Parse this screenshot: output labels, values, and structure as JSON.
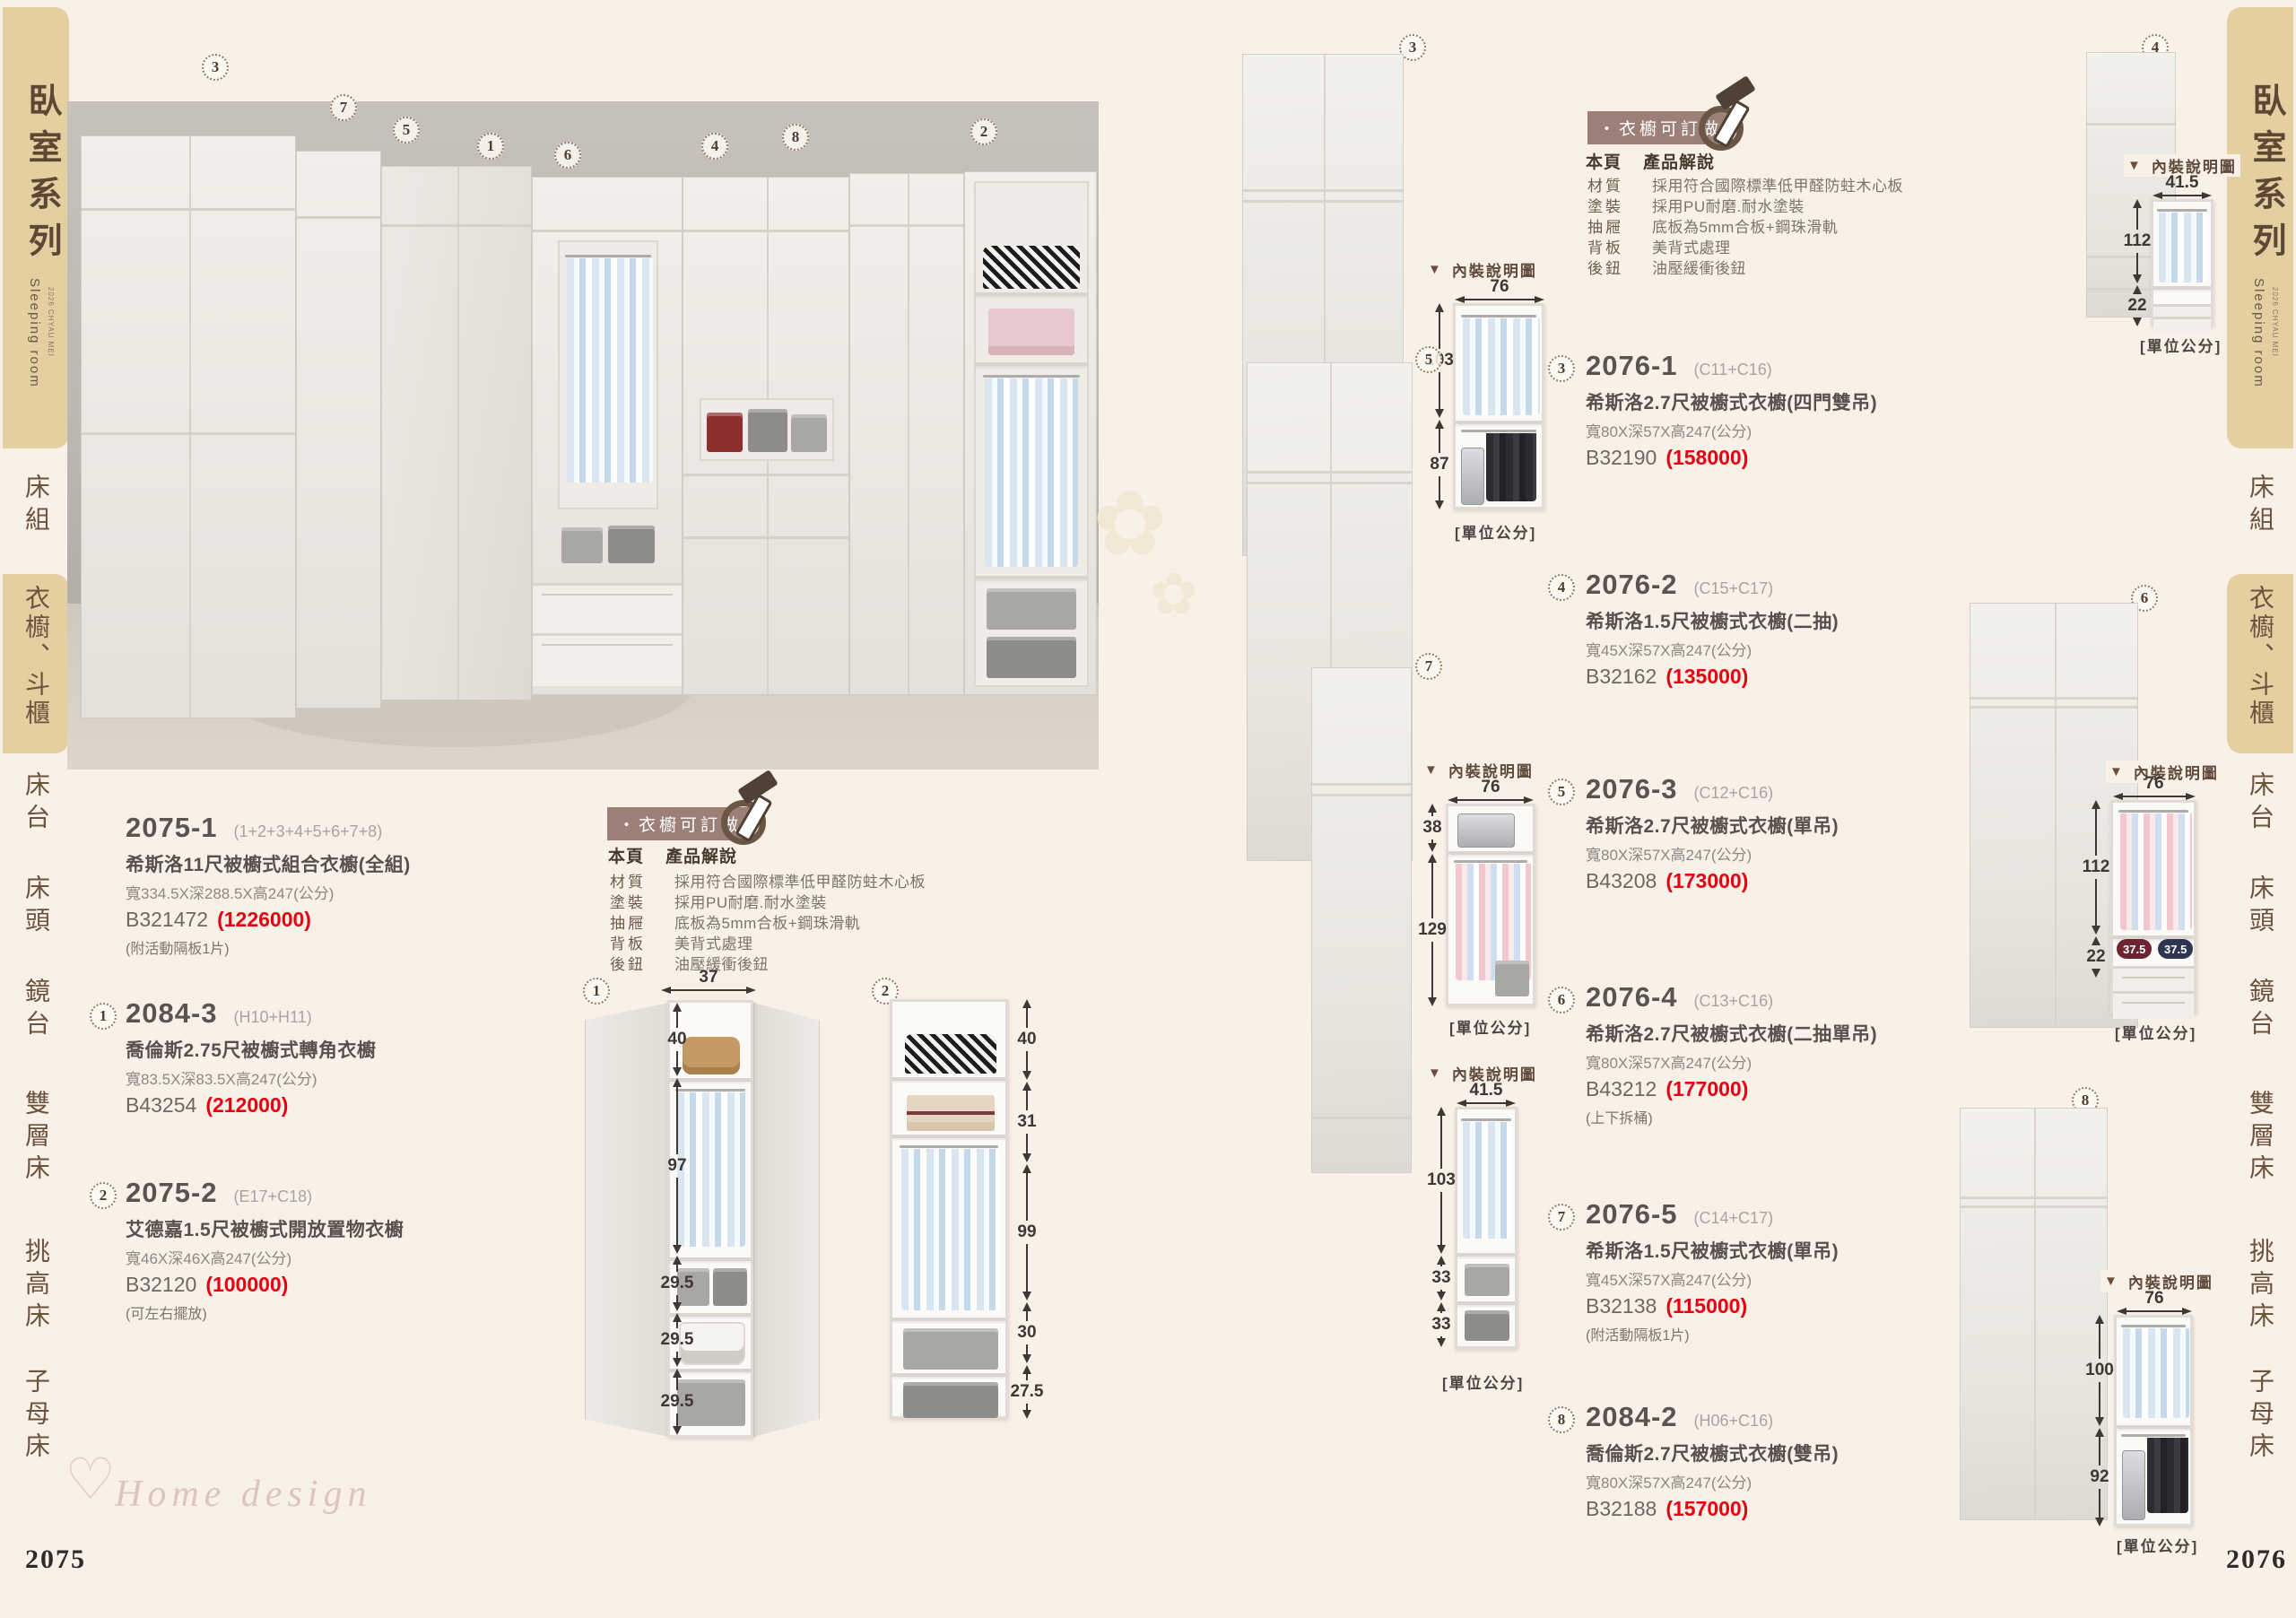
{
  "labels": {
    "diagram_caption": "內裝說明圖",
    "caption_arrow": "▼",
    "unit": "[單位公分]"
  },
  "sidebar": {
    "title": "臥室系列",
    "subtitle": "Sleeping room",
    "note": "2026 CHYAU MEI",
    "items": [
      "床組",
      "衣櫥、斗櫃",
      "床台",
      "床頭",
      "鏡台",
      "雙層床",
      "挑高床",
      "子母床"
    ]
  },
  "spec": {
    "badge": "・衣櫥可訂做",
    "header_page": "本頁",
    "header_title": "產品解說",
    "rows": [
      {
        "k": "材質",
        "v": "採用符合國際標準低甲醛防蛀木心板"
      },
      {
        "k": "塗裝",
        "v": "採用PU耐磨.耐水塗裝"
      },
      {
        "k": "抽屜",
        "v": "底板為5mm合板+鋼珠滑軌"
      },
      {
        "k": "背板",
        "v": "美背式處理"
      },
      {
        "k": "後鈕",
        "v": "油壓緩衝後鈕"
      }
    ]
  },
  "left_page": {
    "page_number": "2075",
    "watermark_heart": "♡",
    "watermark": "Home design",
    "flower": "✿",
    "photo_markers": [
      "3",
      "7",
      "5",
      "1",
      "6",
      "4",
      "8",
      "2"
    ],
    "products": [
      {
        "code": "2075-1",
        "combo": "(1+2+3+4+5+6+7+8)",
        "name": "希斯洛11尺被櫥式組合衣櫥(全組)",
        "size": "寬334.5X深288.5X高247(公分)",
        "sku": "B321472",
        "price": "(1226000)",
        "note": "(附活動隔板1片)"
      },
      {
        "marker": "1",
        "code": "2084-3",
        "combo": "(H10+H11)",
        "name": "喬倫斯2.75尺被櫥式轉角衣櫥",
        "size": "寬83.5X深83.5X高247(公分)",
        "sku": "B43254",
        "price": "(212000)"
      },
      {
        "marker": "2",
        "code": "2075-2",
        "combo": "(E17+C18)",
        "name": "艾德嘉1.5尺被櫥式開放置物衣櫥",
        "size": "寬46X深46X高247(公分)",
        "sku": "B32120",
        "price": "(100000)",
        "note": "(可左右擺放)"
      }
    ],
    "diagram1": {
      "marker": "1",
      "width": "37",
      "s0": "40",
      "s1": "97",
      "s2": "29.5",
      "s3": "29.5",
      "s4": "29.5"
    },
    "diagram2": {
      "marker": "2",
      "s0": "40",
      "s1": "31",
      "s2": "99",
      "s3": "30",
      "s4": "27.5"
    }
  },
  "right_page": {
    "page_number": "2076",
    "photo_markers": [
      "3",
      "4",
      "5",
      "6",
      "7",
      "8"
    ],
    "products": [
      {
        "marker": "3",
        "code": "2076-1",
        "combo": "(C11+C16)",
        "name": "希斯洛2.7尺被櫥式衣櫥(四門雙吊)",
        "size": "寬80X深57X高247(公分)",
        "sku": "B32190",
        "price": "(158000)"
      },
      {
        "marker": "4",
        "code": "2076-2",
        "combo": "(C15+C17)",
        "name": "希斯洛1.5尺被櫥式衣櫥(二抽)",
        "size": "寬45X深57X高247(公分)",
        "sku": "B32162",
        "price": "(135000)"
      },
      {
        "marker": "5",
        "code": "2076-3",
        "combo": "(C12+C16)",
        "name": "希斯洛2.7尺被櫥式衣櫥(單吊)",
        "size": "寬80X深57X高247(公分)",
        "sku": "B43208",
        "price": "(173000)"
      },
      {
        "marker": "6",
        "code": "2076-4",
        "combo": "(C13+C16)",
        "name": "希斯洛2.7尺被櫥式衣櫥(二抽單吊)",
        "size": "寬80X深57X高247(公分)",
        "sku": "B43212",
        "price": "(177000)",
        "note": "(上下拆桶)"
      },
      {
        "marker": "7",
        "code": "2076-5",
        "combo": "(C14+C17)",
        "name": "希斯洛1.5尺被櫥式衣櫥(單吊)",
        "size": "寬45X深57X高247(公分)",
        "sku": "B32138",
        "price": "(115000)",
        "note": "(附活動隔板1片)"
      },
      {
        "marker": "8",
        "code": "2084-2",
        "combo": "(H06+C16)",
        "name": "喬倫斯2.7尺被櫥式衣櫥(雙吊)",
        "size": "寬80X深57X高247(公分)",
        "sku": "B32188",
        "price": "(157000)"
      }
    ],
    "diagrams": {
      "d3": {
        "width": "76",
        "s0": "103",
        "s1": "87"
      },
      "d4": {
        "width": "41.5",
        "s0": "112",
        "s1": "22"
      },
      "d5": {
        "width": "76",
        "s0": "38",
        "s1": "129"
      },
      "d6": {
        "width": "76",
        "s0": "112",
        "s1": "22",
        "w0": "37.5",
        "w1": "37.5"
      },
      "d7": {
        "width": "41.5",
        "s0": "103",
        "s1": "33",
        "s2": "33"
      },
      "d8": {
        "width": "76",
        "s0": "100",
        "s1": "92"
      }
    }
  }
}
